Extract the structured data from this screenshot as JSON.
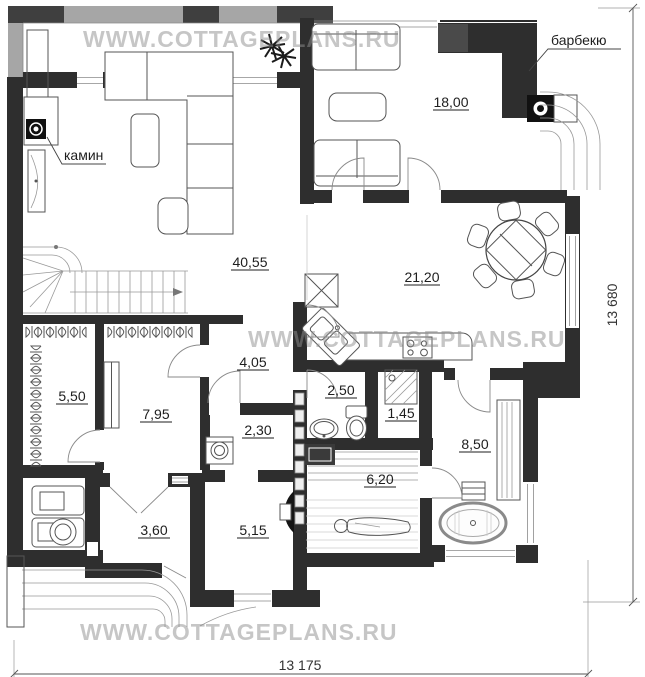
{
  "watermark": "WWW.COTTAGEPLANS.RU",
  "annotations": {
    "fireplace": "камин",
    "barbecue": "барбекю"
  },
  "rooms": {
    "living": "40,55",
    "terrace": "18,00",
    "kitchen_dining": "21,20",
    "hallway": "4,05",
    "wc": "2,50",
    "shower": "1,45",
    "wardrobe": "5,50",
    "hall": "7,95",
    "laundry": "2,30",
    "bathroom": "8,50",
    "sauna": "6,20",
    "vestibule": "3,60",
    "sauna_anteroom": "5,15"
  },
  "dimensions": {
    "width": "13 175",
    "height": "13 680"
  },
  "colors": {
    "wall": "#2e2e2e",
    "deck_band": "#a6a6a6",
    "deck_block": "#3f3f3f",
    "watermark": "#8f8f8f",
    "furniture_stroke": "#555555",
    "label_text": "#1e1e1e"
  }
}
